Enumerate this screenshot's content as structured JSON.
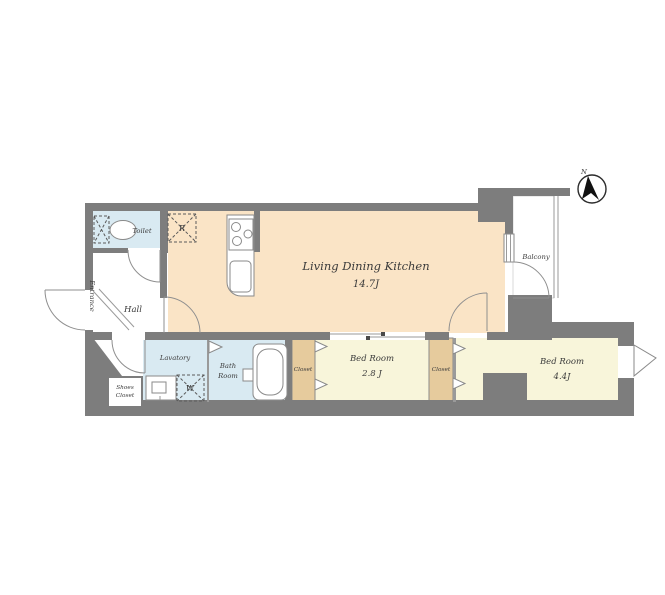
{
  "plan": {
    "type": "apartment-floor-plan",
    "units": "J (tatami mats)"
  },
  "colors": {
    "wall": "#7d7d7d",
    "ldk_floor": "#fae4c6",
    "bedroom_floor": "#f8f5da",
    "closet_floor": "#e6cb9d",
    "water_floor": "#d9eaf2",
    "text": "#3b3b3b",
    "north_needle": "#111111"
  },
  "rooms": {
    "ldk": {
      "label": "Living Dining Kitchen",
      "size": "14.7J"
    },
    "bedroom_small": {
      "label": "Bed Room",
      "size": "2.8 J"
    },
    "bedroom_large": {
      "label": "Bed Room",
      "size": "4.4J"
    },
    "toilet": {
      "label": "Toilet"
    },
    "hall": {
      "label": "Hall"
    },
    "entrance": {
      "label": "Entrance"
    },
    "lavatory": {
      "label": "Lavatory"
    },
    "bathroom": {
      "label_line1": "Bath",
      "label_line2": "Room"
    },
    "balcony": {
      "label": "Balcony"
    },
    "shoes_closet": {
      "label_line1": "Shoes",
      "label_line2": "Closet"
    },
    "closet_bedroom_small": {
      "label": "Closet"
    },
    "closet_bedroom_large": {
      "label": "Closet"
    }
  },
  "symbols": {
    "refrigerator": "R",
    "washing_machine": "W",
    "compass_north": "N"
  }
}
